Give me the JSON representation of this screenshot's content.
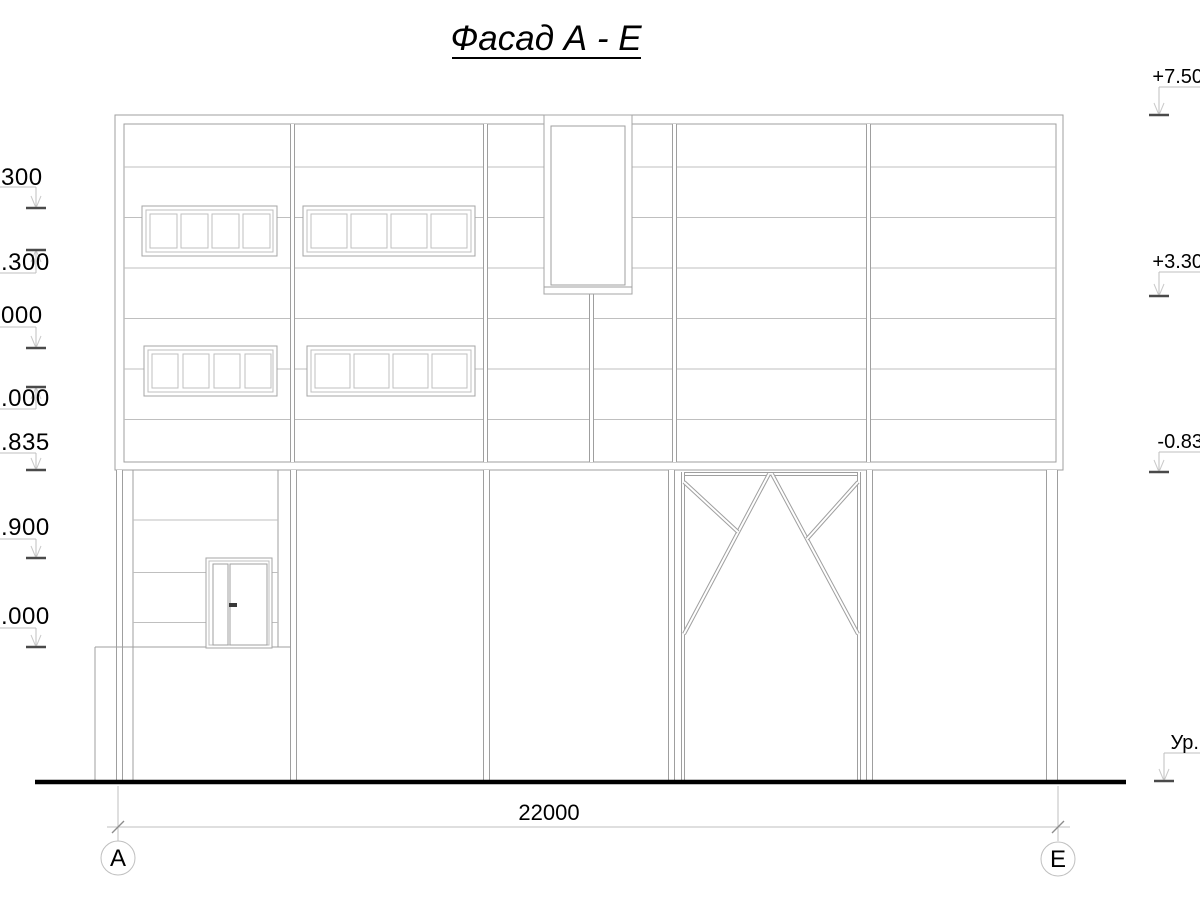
{
  "title": "Фасад А - Е",
  "dimension": {
    "overall_width": "22000"
  },
  "axis_markers": {
    "left": "А",
    "right": "Е"
  },
  "elevation_marks_left": [
    {
      "label": "300"
    },
    {
      "label": ".300"
    },
    {
      "label": "000"
    },
    {
      "label": ".000"
    },
    {
      "label": ".835"
    },
    {
      "label": ".900"
    },
    {
      "label": ".000"
    }
  ],
  "elevation_marks_right": [
    {
      "label": "+7.50"
    },
    {
      "label": "+3.30"
    },
    {
      "label": "-0.83"
    },
    {
      "label": "Ур."
    }
  ],
  "colors": {
    "line": "#9f9f9f",
    "light_line": "#bfbfbf",
    "text": "#000000",
    "ground_line": "#000000"
  }
}
